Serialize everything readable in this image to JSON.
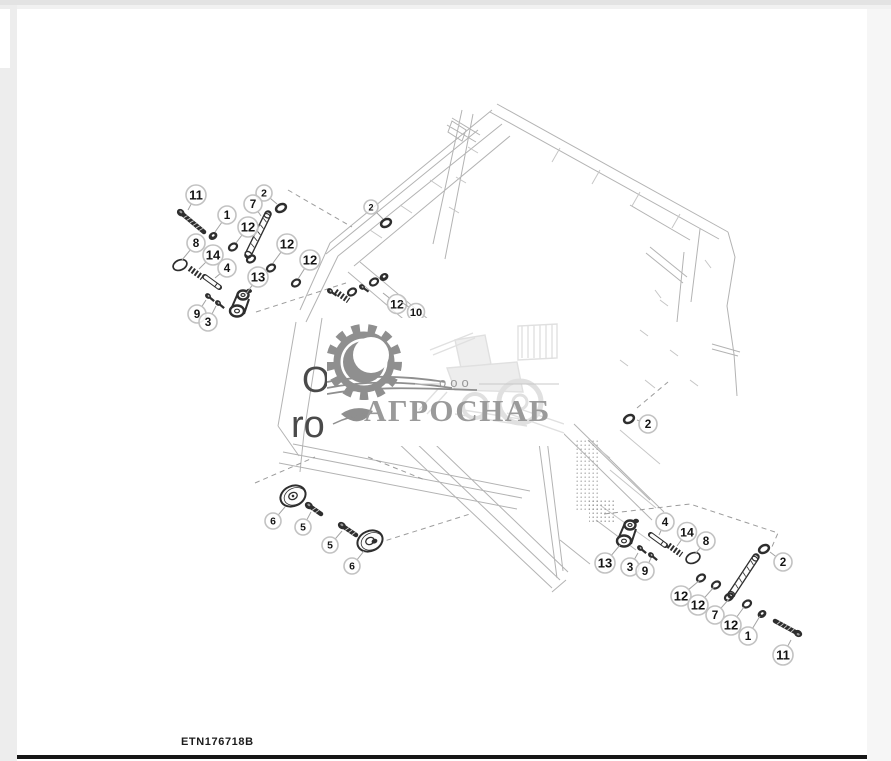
{
  "page": {
    "footer_code": "ETN176718B"
  },
  "watermark": {
    "company_type": "ооо",
    "company_name": "АГРОСНАБ"
  },
  "underlay_text": {
    "line1": "O",
    "line2": "ro"
  },
  "colors": {
    "part_ink": "#2e2e2e",
    "wireframe": "#b3b3b3",
    "wireframe_light": "#c6c6c6",
    "dash_line": "#9c9c9c",
    "leader_line": "#a2a2a2",
    "callout_ring": "#c2c2c2",
    "callout_text": "#151515",
    "watermark_gray": "#8f8f8f",
    "watermark_light": "#e0e0e0",
    "footer_line": "#161616"
  },
  "diagram": {
    "callouts": [
      {
        "label": "11",
        "x": 196,
        "y": 195,
        "r": 10,
        "tx": 188,
        "ty": 210
      },
      {
        "label": "2",
        "x": 264,
        "y": 193,
        "r": 8,
        "tx": 277,
        "ty": 204
      },
      {
        "label": "7",
        "x": 253,
        "y": 204,
        "r": 9,
        "tx": 261,
        "ty": 216
      },
      {
        "label": "1",
        "x": 227,
        "y": 215,
        "r": 9,
        "tx": 215,
        "ty": 232
      },
      {
        "label": "12",
        "x": 248,
        "y": 227,
        "r": 10,
        "tx": 236,
        "ty": 243
      },
      {
        "label": "8",
        "x": 196,
        "y": 243,
        "r": 9,
        "tx": 182,
        "ty": 260
      },
      {
        "label": "14",
        "x": 213,
        "y": 255,
        "r": 10,
        "tx": 199,
        "ty": 269
      },
      {
        "label": "12",
        "x": 287,
        "y": 244,
        "r": 10,
        "tx": 273,
        "ty": 263
      },
      {
        "label": "4",
        "x": 227,
        "y": 268,
        "r": 9,
        "tx": 215,
        "ty": 278
      },
      {
        "label": "12",
        "x": 310,
        "y": 260,
        "r": 10,
        "tx": 298,
        "ty": 279
      },
      {
        "label": "13",
        "x": 258,
        "y": 277,
        "r": 10,
        "tx": 246,
        "ty": 294
      },
      {
        "label": "9",
        "x": 197,
        "y": 314,
        "r": 9,
        "tx": 206,
        "ty": 300
      },
      {
        "label": "3",
        "x": 208,
        "y": 322,
        "r": 9,
        "tx": 216,
        "ty": 306
      },
      {
        "label": "2",
        "x": 371,
        "y": 207,
        "r": 7,
        "tx": 383,
        "ty": 219
      },
      {
        "label": "12",
        "x": 397,
        "y": 304,
        "r": 9.5,
        "tx": 383,
        "ty": 293
      },
      {
        "label": "10",
        "x": 416,
        "y": 312,
        "r": 8.5,
        "tx": 400,
        "ty": 301
      },
      {
        "label": "2",
        "x": 648,
        "y": 424,
        "r": 9,
        "tx": 637,
        "ty": 420
      },
      {
        "label": "6",
        "x": 273,
        "y": 521,
        "r": 8,
        "tx": 285,
        "ty": 507
      },
      {
        "label": "5",
        "x": 303,
        "y": 527,
        "r": 8,
        "tx": 311,
        "ty": 512
      },
      {
        "label": "5",
        "x": 330,
        "y": 545,
        "r": 8,
        "tx": 342,
        "ty": 531
      },
      {
        "label": "6",
        "x": 352,
        "y": 566,
        "r": 8,
        "tx": 364,
        "ty": 551
      },
      {
        "label": "13",
        "x": 605,
        "y": 563,
        "r": 10,
        "tx": 620,
        "ty": 545
      },
      {
        "label": "3",
        "x": 630,
        "y": 567,
        "r": 9,
        "tx": 638,
        "ty": 553
      },
      {
        "label": "9",
        "x": 645,
        "y": 571,
        "r": 9,
        "tx": 651,
        "ty": 558
      },
      {
        "label": "4",
        "x": 665,
        "y": 522,
        "r": 9,
        "tx": 659,
        "ty": 535
      },
      {
        "label": "14",
        "x": 687,
        "y": 532,
        "r": 9.5,
        "tx": 677,
        "ty": 546
      },
      {
        "label": "8",
        "x": 706,
        "y": 541,
        "r": 9,
        "tx": 695,
        "ty": 554
      },
      {
        "label": "2",
        "x": 783,
        "y": 562,
        "r": 9,
        "tx": 770,
        "ty": 552
      },
      {
        "label": "12",
        "x": 681,
        "y": 596,
        "r": 10,
        "tx": 700,
        "ty": 580
      },
      {
        "label": "12",
        "x": 698,
        "y": 605,
        "r": 10,
        "tx": 714,
        "ty": 587
      },
      {
        "label": "7",
        "x": 715,
        "y": 615,
        "r": 9,
        "tx": 729,
        "ty": 599
      },
      {
        "label": "12",
        "x": 731,
        "y": 625,
        "r": 10,
        "tx": 744,
        "ty": 607
      },
      {
        "label": "1",
        "x": 748,
        "y": 636,
        "r": 9,
        "tx": 760,
        "ty": 616
      },
      {
        "label": "11",
        "x": 783,
        "y": 655,
        "r": 10,
        "tx": 791,
        "ty": 640
      }
    ],
    "parts": [
      {
        "type": "bolt",
        "hx": 180,
        "hy": 212,
        "tx": 204,
        "ty": 232
      },
      {
        "type": "nut",
        "x": 213,
        "y": 236
      },
      {
        "type": "washer",
        "x": 233,
        "y": 247
      },
      {
        "type": "ring",
        "x": 281,
        "y": 208
      },
      {
        "type": "rod",
        "x1": 268,
        "y1": 214,
        "x2": 248,
        "y2": 255
      },
      {
        "type": "washer",
        "x": 251,
        "y": 259
      },
      {
        "type": "washer",
        "x": 271,
        "y": 268
      },
      {
        "type": "washer",
        "x": 296,
        "y": 283
      },
      {
        "type": "oring",
        "x": 180,
        "y": 265
      },
      {
        "type": "spring",
        "x": 196,
        "y": 273,
        "rot": 36
      },
      {
        "type": "pin",
        "x": 212,
        "y": 282,
        "rot": 36
      },
      {
        "type": "smallbolt",
        "x": 208,
        "y": 296,
        "rot": 40
      },
      {
        "type": "smallbolt",
        "x": 218,
        "y": 303,
        "rot": 40
      },
      {
        "type": "bracket",
        "x": 241,
        "y": 301
      },
      {
        "type": "smallbolt",
        "x": 330,
        "y": 291,
        "rot": 35
      },
      {
        "type": "spring",
        "x": 342,
        "y": 296,
        "rot": 35
      },
      {
        "type": "washer",
        "x": 352,
        "y": 292
      },
      {
        "type": "smallbolt",
        "x": 362,
        "y": 287,
        "rot": 35
      },
      {
        "type": "washer",
        "x": 374,
        "y": 282
      },
      {
        "type": "nut",
        "x": 384,
        "y": 277
      },
      {
        "type": "ring",
        "x": 386,
        "y": 223
      },
      {
        "type": "ring",
        "x": 629,
        "y": 419
      },
      {
        "type": "disc",
        "x": 293,
        "y": 496,
        "rot": -24
      },
      {
        "type": "bolt",
        "hx": 308,
        "hy": 505,
        "tx": 321,
        "ty": 514
      },
      {
        "type": "bolt",
        "hx": 341,
        "hy": 525,
        "tx": 356,
        "ty": 535
      },
      {
        "type": "disc",
        "x": 370,
        "y": 541,
        "rot": -24,
        "hub": true
      },
      {
        "type": "bracket",
        "x": 628,
        "y": 531
      },
      {
        "type": "pin",
        "x": 658,
        "y": 540,
        "rot": 36
      },
      {
        "type": "spring",
        "x": 675,
        "y": 550,
        "rot": 36
      },
      {
        "type": "oring",
        "x": 693,
        "y": 558
      },
      {
        "type": "smallbolt",
        "x": 640,
        "y": 548,
        "rot": 40
      },
      {
        "type": "smallbolt",
        "x": 651,
        "y": 555,
        "rot": 40
      },
      {
        "type": "ring",
        "x": 764,
        "y": 549
      },
      {
        "type": "washer",
        "x": 701,
        "y": 578
      },
      {
        "type": "washer",
        "x": 716,
        "y": 585
      },
      {
        "type": "rod",
        "x1": 756,
        "y1": 557,
        "x2": 731,
        "y2": 595
      },
      {
        "type": "washer",
        "x": 729,
        "y": 597
      },
      {
        "type": "washer",
        "x": 747,
        "y": 604
      },
      {
        "type": "nut",
        "x": 762,
        "y": 614
      },
      {
        "type": "bolt",
        "hx": 799,
        "hy": 634,
        "tx": 775,
        "ty": 621
      }
    ]
  }
}
